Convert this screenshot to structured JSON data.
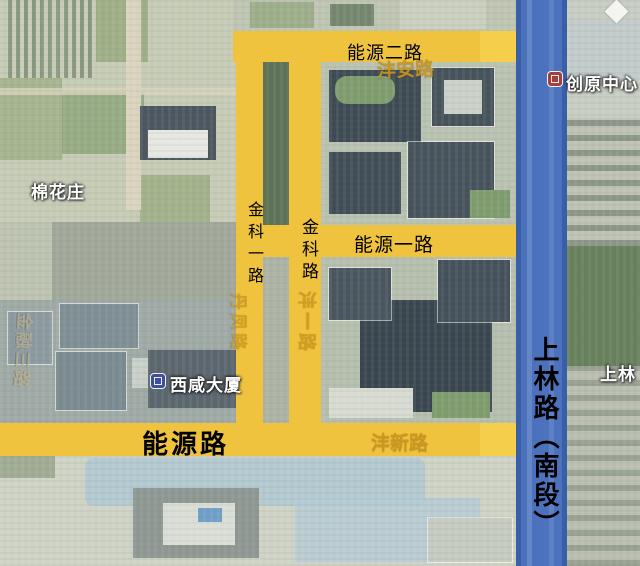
{
  "map": {
    "overlay_road_labels": {
      "nengyuan_er": "能源二路",
      "nengyuan_yi": "能源一路",
      "nengyuan": "能源路",
      "jinke_yi": "金科一路",
      "jinke": "金科路",
      "shanglin_nanduan": "上林路（南段）"
    },
    "base_map_labels": {
      "mianhuazhuang": "棉花庄",
      "chuangyuan_center": "创原中心",
      "xixian_building": "西咸大厦",
      "shanglin_partial": "上林",
      "fengan_road": "沣安路",
      "fengxin_road": "沣新路",
      "danfeng_road": "丹凤路",
      "fengyi_road": "沣一路",
      "jinrong_san_road": "金融三路"
    },
    "icons": {
      "chuangyuan_center_icon": "building-icon",
      "xixian_building_icon": "building-icon",
      "poi_diamond": "diamond-marker-icon"
    },
    "colors": {
      "highlight_road_yellow": "#EFC33E",
      "highlight_road_yellow_bright": "#F5CE4B",
      "main_road_blue": "#4C72BE",
      "main_road_blue_edge": "#3A5FA9",
      "overlay_label_text": "#000000",
      "poi_label_text": "#FFFFFF",
      "faded_base_label": "#CD961E"
    }
  }
}
